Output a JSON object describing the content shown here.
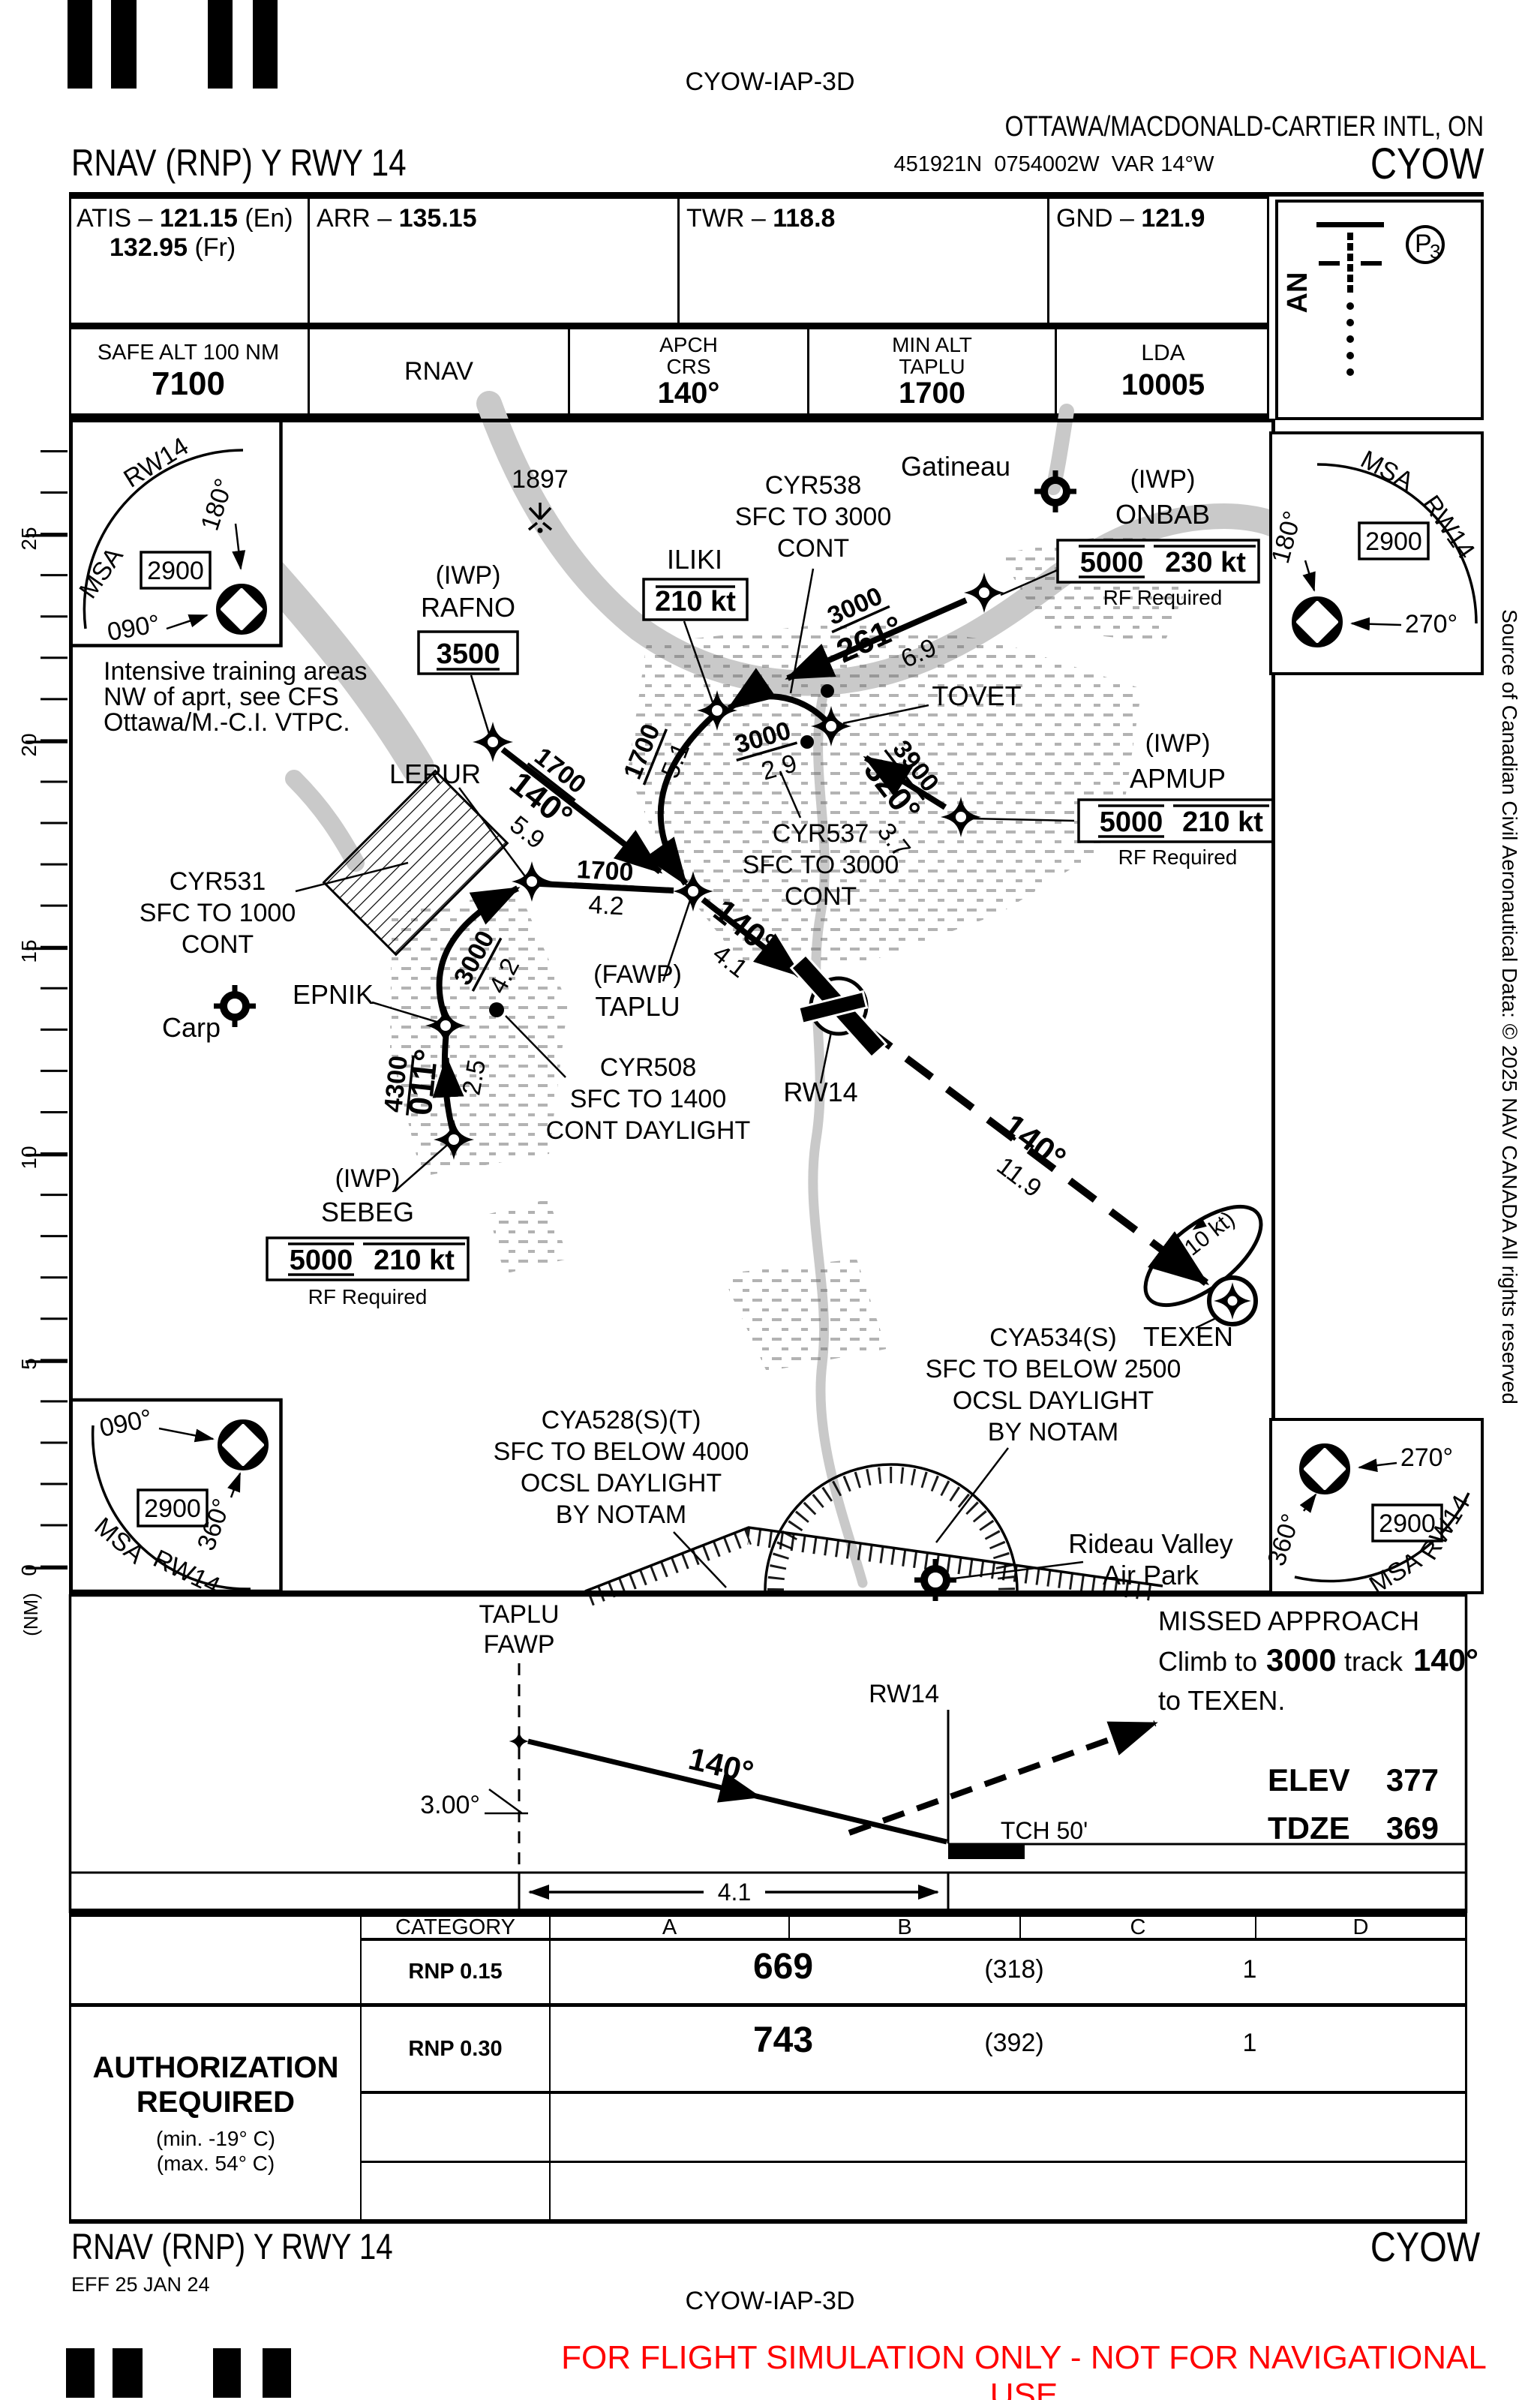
{
  "page": {
    "code": "CYOW-IAP-3D",
    "airport": "OTTAWA/MACDONALD-CARTIER INTL, ON",
    "title": "RNAV (RNP) Y RWY 14",
    "coords": "451921N  0754002W  VAR 14°W",
    "icao": "CYOW",
    "eff": "EFF 25 JAN 24",
    "disclaimer": "FOR FLIGHT SIMULATION ONLY - NOT FOR NAVIGATIONAL USE",
    "source": "Source of Canadian Civil Aeronautical Data: © 2025 NAV CANADA All rights reserved"
  },
  "freq": {
    "atis_label": "ATIS –",
    "atis_value": "121.15",
    "atis_note": "(En)",
    "atis_value2": "132.95",
    "atis_note2": "(Fr)",
    "arr_label": "ARR –",
    "arr_value": "135.15",
    "twr_label": "TWR –",
    "twr_value": "118.8",
    "gnd_label": "GND –",
    "gnd_value": "121.9"
  },
  "info": {
    "safe_label": "SAFE ALT 100 NM",
    "safe_value": "7100",
    "nav": "RNAV",
    "crs_l1": "APCH",
    "crs_l2": "CRS",
    "crs_value": "140°",
    "minalt_l1": "MIN ALT",
    "minalt_l2": "TAPLU",
    "minalt_value": "1700",
    "lda_label": "LDA",
    "lda_value": "10005",
    "an": "AN",
    "p": "P",
    "p_sub": "3"
  },
  "msa": {
    "alt": "2900",
    "msa": "MSA",
    "rwy": "RW14",
    "d090": "090°",
    "d180": "180°",
    "d270": "270°",
    "d360": "360°"
  },
  "plan": {
    "ruler": [
      "25",
      "20",
      "15",
      "10",
      "5",
      "0"
    ],
    "ruler_unit": "(NM)",
    "note1": "Intensive training areas",
    "note2": "NW of aprt, see CFS",
    "note3": "Ottawa/M.-C.I. VTPC.",
    "obstacle": "1897",
    "gatineau": "Gatineau",
    "carp": "Carp",
    "rideau1": "Rideau Valley",
    "rideau2": "Air Park",
    "iwp": "(IWP)",
    "rf": "RF Required",
    "onbab": "ONBAB",
    "onbab_alt": "5000",
    "onbab_spd": "230 kt",
    "iliki": "ILIKI",
    "iliki_spd": "210 kt",
    "tovet": "TOVET",
    "apmup": "APMUP",
    "apmup_alt": "5000",
    "apmup_spd": "210 kt",
    "rafno": "RAFNO",
    "rafno_alt": "3500",
    "lerur": "LERUR",
    "fawp": "(FAWP)",
    "taplu": "TAPLU",
    "epnik": "EPNIK",
    "sebeg": "SEBEG",
    "sebeg_alt": "5000",
    "sebeg_spd": "210 kt",
    "rw14": "RW14",
    "texen": "TEXEN",
    "hold": "(210 kt)",
    "leg_onbab_alt": "3000",
    "leg_onbab_crs": "261°",
    "leg_onbab_dist": "6.9",
    "leg_tovet_alt": "3000",
    "leg_tovet_dist": "2.9",
    "leg_apmup_alt": "3900",
    "leg_apmup_crs": "320°",
    "leg_apmup_dist": "3.7",
    "leg_iliki_alt": "1700",
    "leg_iliki_dist": "5.1",
    "leg_rafno_alt": "1700",
    "leg_rafno_crs": "140°",
    "leg_rafno_dist": "5.9",
    "leg_lerur_alt": "1700",
    "leg_lerur_dist": "4.2",
    "leg_final_crs": "140°",
    "leg_final_dist": "4.1",
    "leg_sebeg_alt": "4300",
    "leg_sebeg_crs": "011°",
    "leg_sebeg_dist": "2.5",
    "leg_epnik_alt": "3000",
    "leg_epnik_dist": "4.2",
    "leg_missed_crs": "140°",
    "leg_missed_dist": "11.9",
    "cyr531": [
      "CYR531",
      "SFC TO 1000",
      "CONT"
    ],
    "cyr508": [
      "CYR508",
      "SFC TO 1400",
      "CONT DAYLIGHT"
    ],
    "cyr537": [
      "CYR537",
      "SFC TO 3000",
      "CONT"
    ],
    "cyr538": [
      "CYR538",
      "SFC TO 3000",
      "CONT"
    ],
    "cya534": [
      "CYA534(S)",
      "SFC TO BELOW 2500",
      "OCSL DAYLIGHT",
      "BY NOTAM"
    ],
    "cya528": [
      "CYA528(S)(T)",
      "SFC TO BELOW 4000",
      "OCSL DAYLIGHT",
      "BY NOTAM"
    ]
  },
  "profile": {
    "fix1": "TAPLU",
    "fix2": "FAWP",
    "crs": "140°",
    "angle": "3.00°",
    "rw": "RW14",
    "tch": "TCH 50'",
    "dist": "4.1",
    "ma1": "MISSED APPROACH",
    "ma2a": "Climb to",
    "ma2b": "3000",
    "ma2c": "track",
    "ma2d": "140°",
    "ma3": "to TEXEN.",
    "elev_label": "ELEV",
    "elev": "377",
    "tdze_label": "TDZE",
    "tdze": "369"
  },
  "minima": {
    "headers": [
      "CATEGORY",
      "A",
      "B",
      "C",
      "D"
    ],
    "rows": [
      {
        "cat": "RNP 0.15",
        "da": "669",
        "hat": "(318)",
        "vis": "1"
      },
      {
        "cat": "RNP 0.30",
        "da": "743",
        "hat": "(392)",
        "vis": "1"
      }
    ],
    "auth1": "AUTHORIZATION",
    "auth2": "REQUIRED",
    "auth3": "(min. -19° C)",
    "auth4": "(max. 54° C)"
  }
}
